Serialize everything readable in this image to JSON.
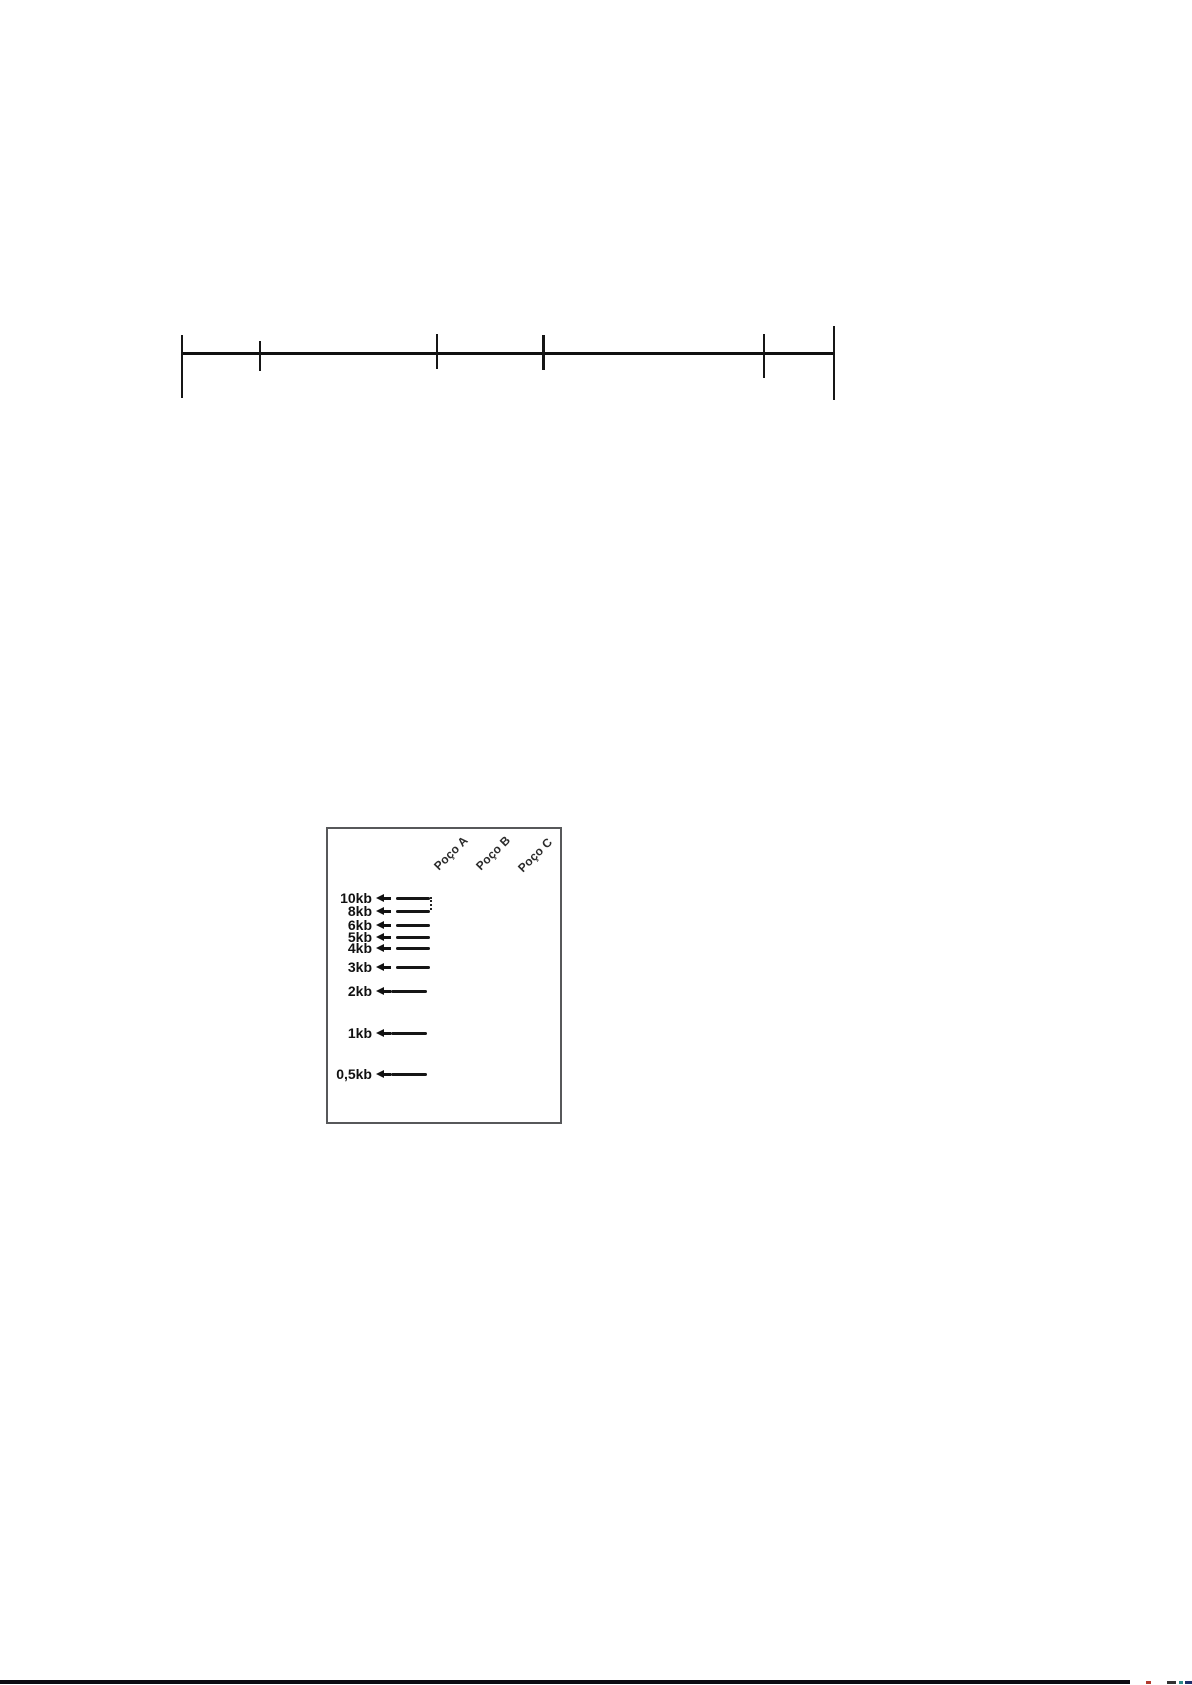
{
  "figure": {
    "ruler": {
      "baseline": {
        "x1": 182,
        "x2": 835,
        "y": 352,
        "thickness": 3
      },
      "ticks": [
        {
          "x": 182,
          "top": 335,
          "bottom": 398,
          "weight": "normal"
        },
        {
          "x": 260,
          "top": 341,
          "bottom": 371,
          "weight": "normal"
        },
        {
          "x": 437,
          "top": 334,
          "bottom": 369,
          "weight": "normal"
        },
        {
          "x": 543,
          "top": 335,
          "bottom": 370,
          "weight": "bold"
        },
        {
          "x": 764,
          "top": 334,
          "bottom": 378,
          "weight": "normal"
        },
        {
          "x": 834,
          "top": 326,
          "bottom": 400,
          "weight": "normal"
        }
      ]
    },
    "gel": {
      "box": {
        "x": 326,
        "y": 827,
        "width": 236,
        "height": 297,
        "border_color": "#57585a"
      },
      "wells": [
        {
          "label": "Poço A",
          "x": 441,
          "y": 873
        },
        {
          "label": "Poço B",
          "x": 483,
          "y": 873
        },
        {
          "label": "Poço C",
          "x": 525,
          "y": 875
        }
      ],
      "ladder": [
        {
          "label": "10kb",
          "size_kb": 10,
          "band_y": 897,
          "arrow": "short"
        },
        {
          "label": "8kb",
          "size_kb": 8,
          "band_y": 910,
          "arrow": "short"
        },
        {
          "label": "6kb",
          "size_kb": 6,
          "band_y": 924,
          "arrow": "short"
        },
        {
          "label": "5kb",
          "size_kb": 5,
          "band_y": 936,
          "arrow": "short"
        },
        {
          "label": "4kb",
          "size_kb": 4,
          "band_y": 947,
          "arrow": "short"
        },
        {
          "label": "3kb",
          "size_kb": 3,
          "band_y": 966,
          "arrow": "short"
        },
        {
          "label": "2kb",
          "size_kb": 2,
          "band_y": 990,
          "arrow": "long"
        },
        {
          "label": "1kb",
          "size_kb": 1,
          "band_y": 1032,
          "arrow": "long"
        },
        {
          "label": "0,5kb",
          "size_kb": 0.5,
          "band_y": 1073,
          "arrow": "long"
        }
      ],
      "bracket": {
        "x": 430,
        "y1": 897,
        "y2": 910
      }
    },
    "bottom_rule": {
      "x": 0,
      "y": 1680,
      "width": 1130,
      "height": 4,
      "color": "#0c0c12"
    },
    "bottom_artifacts": [
      {
        "x": 1146,
        "width": 5,
        "color": "#b23a2e"
      },
      {
        "x": 1167,
        "width": 9,
        "color": "#333333"
      },
      {
        "x": 1179,
        "width": 4,
        "color": "#2e8b8b"
      },
      {
        "x": 1185,
        "width": 7,
        "color": "#1d2d6b"
      }
    ],
    "colors": {
      "ink": "#111111",
      "band": "#151515"
    }
  }
}
